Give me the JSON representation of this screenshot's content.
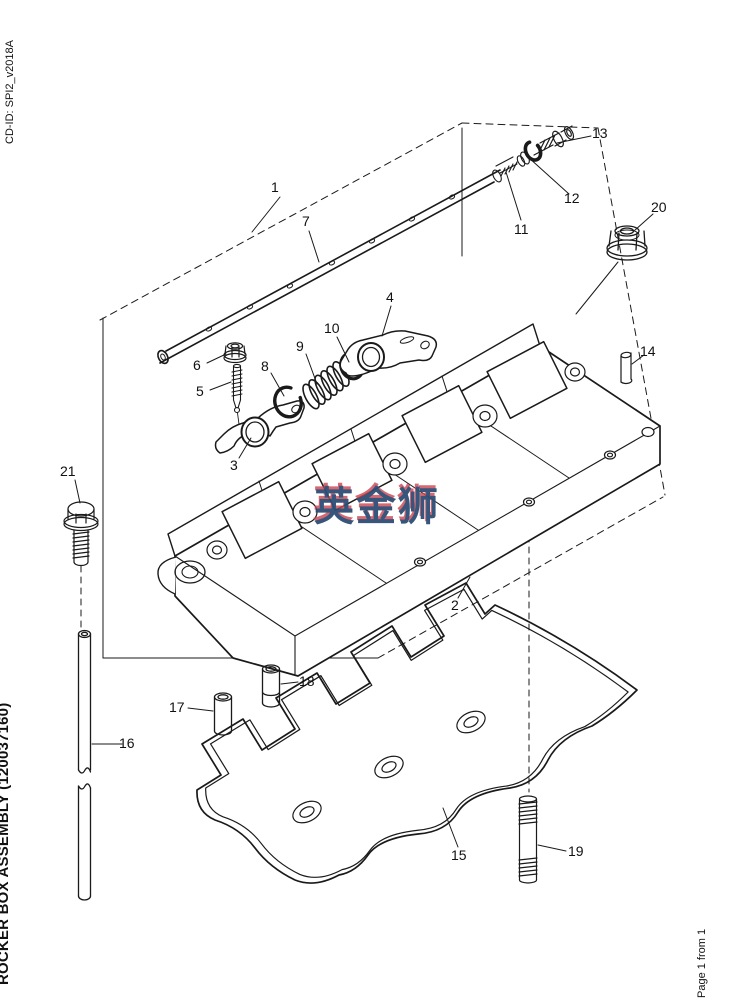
{
  "page": {
    "cd_id": "CD-ID: SPI2_v2018A",
    "assembly_title": "ROCKER BOX ASSEMBLY (120037160)",
    "page_indicator": "Page 1 from 1"
  },
  "watermark": {
    "text": "英金狮",
    "primary_color": "#2e4d74",
    "fringe_color": "#cc4450"
  },
  "diagram": {
    "description": "Exploded parts view of rocker box assembly with numbered callouts",
    "line_color": "#1a1a1a",
    "background": "#ffffff",
    "callouts": [
      "1",
      "2",
      "3",
      "4",
      "5",
      "6",
      "7",
      "8",
      "9",
      "10",
      "11",
      "12",
      "13",
      "14",
      "15",
      "16",
      "17",
      "18",
      "19",
      "20",
      "21"
    ]
  }
}
